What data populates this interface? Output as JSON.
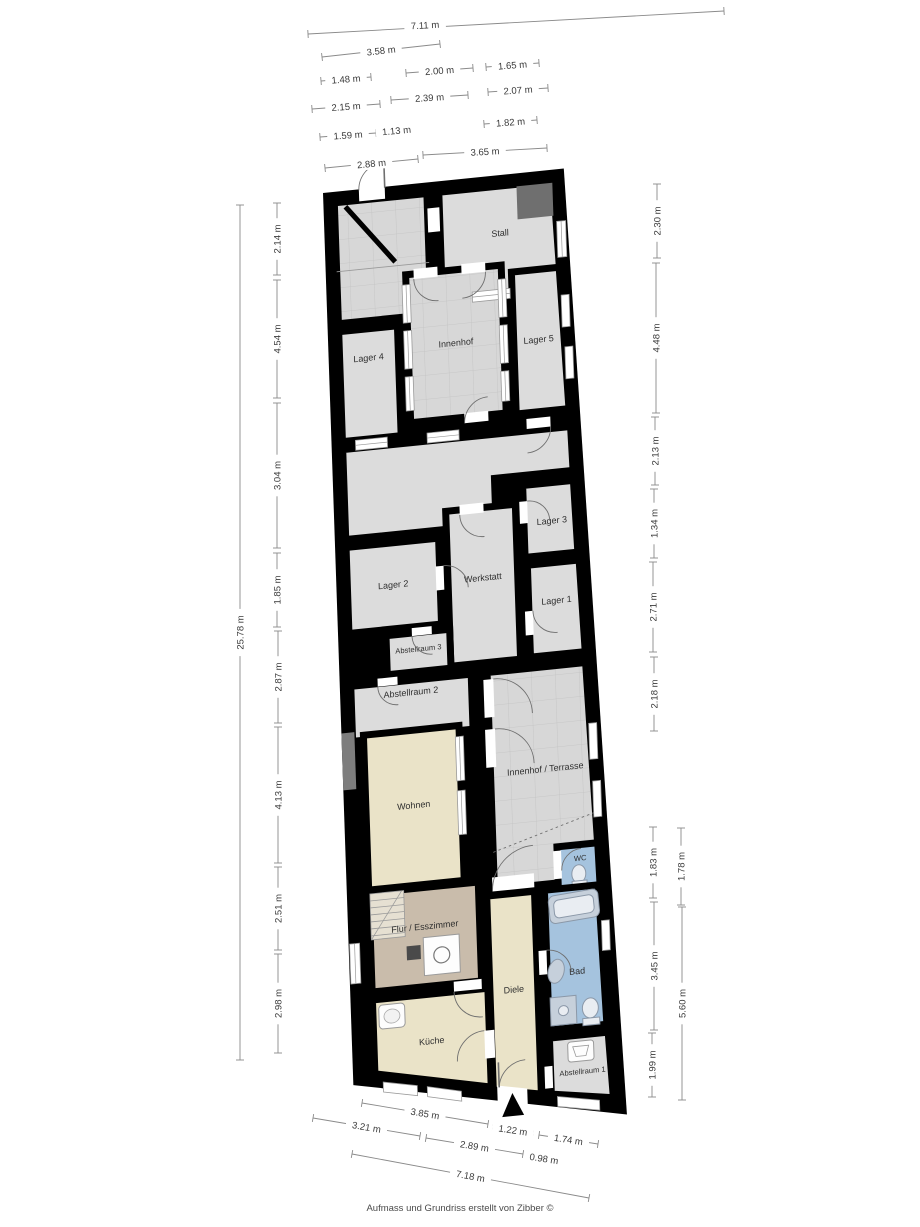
{
  "footer": {
    "credit": "Aufmass und Grundriss erstellt von Zibber ©"
  },
  "colors": {
    "wall": "#000000",
    "room_gray": "#dcdcdc",
    "courtyard_gray": "#d7d7d7",
    "living_cream": "#eae3c8",
    "hall_tan": "#c9bcab",
    "bath_blue": "#a5c3de",
    "dark_block_gray": "#6f6f6f",
    "wall_block_gray": "#7d7d7d",
    "dimension_text": "#3a3a3a"
  },
  "rooms": [
    {
      "id": "stall",
      "label": "Stall"
    },
    {
      "id": "lager-4",
      "label": "Lager 4"
    },
    {
      "id": "innenhof",
      "label": "Innenhof"
    },
    {
      "id": "lager-5",
      "label": "Lager 5"
    },
    {
      "id": "lager-3",
      "label": "Lager 3"
    },
    {
      "id": "lager-2",
      "label": "Lager 2"
    },
    {
      "id": "werkstatt",
      "label": "Werkstatt"
    },
    {
      "id": "lager-1",
      "label": "Lager 1"
    },
    {
      "id": "abstellraum-3",
      "label": "Abstellraum 3"
    },
    {
      "id": "abstellraum-2",
      "label": "Abstellraum 2"
    },
    {
      "id": "innenhof-terrasse",
      "label": "Innenhof / Terrasse"
    },
    {
      "id": "wohnen",
      "label": "Wohnen"
    },
    {
      "id": "wc",
      "label": "WC"
    },
    {
      "id": "flur-esszimmer",
      "label": "Flur / Esszimmer"
    },
    {
      "id": "diele",
      "label": "Diele"
    },
    {
      "id": "bad",
      "label": "Bad"
    },
    {
      "id": "kueche",
      "label": "Küche"
    },
    {
      "id": "abstellraum-1",
      "label": "Abstellraum 1"
    }
  ],
  "measurements": [
    {
      "group": "top",
      "label": "7.11 m",
      "x1": 308,
      "y1": 34,
      "x2": 724,
      "y2": 11,
      "lx": 425,
      "ly": 25
    },
    {
      "group": "top",
      "label": "3.58 m",
      "x1": 322,
      "y1": 57,
      "x2": 440,
      "y2": 44
    },
    {
      "group": "top",
      "label": "1.48 m",
      "x1": 321,
      "y1": 81,
      "x2": 371,
      "y2": 77
    },
    {
      "group": "top",
      "label": "2.00 m",
      "x1": 406,
      "y1": 73,
      "x2": 473,
      "y2": 68
    },
    {
      "group": "top",
      "label": "1.65 m",
      "x1": 486,
      "y1": 67,
      "x2": 539,
      "y2": 63
    },
    {
      "group": "top",
      "label": "2.15 m",
      "x1": 312,
      "y1": 109,
      "x2": 380,
      "y2": 104
    },
    {
      "group": "top",
      "label": "2.39 m",
      "x1": 391,
      "y1": 100,
      "x2": 468,
      "y2": 95
    },
    {
      "group": "top",
      "label": "2.07 m",
      "x1": 488,
      "y1": 92,
      "x2": 548,
      "y2": 88
    },
    {
      "group": "top",
      "label": "1.59 m",
      "x1": 320,
      "y1": 137,
      "x2": 376,
      "y2": 133
    },
    {
      "group": "top",
      "label": "1.13 m",
      "x1": 380,
      "y1": 132,
      "x2": 413,
      "y2": 129
    },
    {
      "group": "top",
      "label": "1.82 m",
      "x1": 484,
      "y1": 124,
      "x2": 537,
      "y2": 120
    },
    {
      "group": "top",
      "label": "2.88 m",
      "x1": 325,
      "y1": 168,
      "x2": 418,
      "y2": 159
    },
    {
      "group": "top",
      "label": "3.65 m",
      "x1": 423,
      "y1": 155,
      "x2": 547,
      "y2": 148
    },
    {
      "group": "left",
      "label": "25.78 m",
      "x1": 240,
      "y1": 1060,
      "x2": 240,
      "y2": 205
    },
    {
      "group": "left",
      "label": "2.14 m",
      "x1": 277,
      "y1": 275,
      "x2": 277,
      "y2": 203
    },
    {
      "group": "left",
      "label": "4.54 m",
      "x1": 277,
      "y1": 398,
      "x2": 277,
      "y2": 280
    },
    {
      "group": "left",
      "label": "3.04 m",
      "x1": 277,
      "y1": 548,
      "x2": 277,
      "y2": 403
    },
    {
      "group": "left",
      "label": "1.85 m",
      "x1": 277,
      "y1": 627,
      "x2": 277,
      "y2": 553
    },
    {
      "group": "left",
      "label": "2.87 m",
      "x1": 278,
      "y1": 723,
      "x2": 278,
      "y2": 631
    },
    {
      "group": "left",
      "label": "4.13 m",
      "x1": 278,
      "y1": 863,
      "x2": 278,
      "y2": 727
    },
    {
      "group": "left",
      "label": "2.51 m",
      "x1": 278,
      "y1": 950,
      "x2": 278,
      "y2": 867
    },
    {
      "group": "left",
      "label": "2.98 m",
      "x1": 278,
      "y1": 1053,
      "x2": 278,
      "y2": 954
    },
    {
      "group": "right",
      "label": "2.30 m",
      "x1": 657,
      "y1": 258,
      "x2": 657,
      "y2": 184
    },
    {
      "group": "right",
      "label": "4.48 m",
      "x1": 656,
      "y1": 413,
      "x2": 656,
      "y2": 263
    },
    {
      "group": "right",
      "label": "2.13 m",
      "x1": 655,
      "y1": 485,
      "x2": 655,
      "y2": 417
    },
    {
      "group": "right",
      "label": "1.34 m",
      "x1": 654,
      "y1": 558,
      "x2": 654,
      "y2": 489
    },
    {
      "group": "right",
      "label": "2.71 m",
      "x1": 653,
      "y1": 652,
      "x2": 653,
      "y2": 562
    },
    {
      "group": "right",
      "label": "2.18 m",
      "x1": 654,
      "y1": 731,
      "x2": 654,
      "y2": 657
    },
    {
      "group": "right",
      "label": "1.83 m",
      "x1": 653,
      "y1": 898,
      "x2": 653,
      "y2": 827
    },
    {
      "group": "right",
      "label": "3.45 m",
      "x1": 654,
      "y1": 1030,
      "x2": 654,
      "y2": 902
    },
    {
      "group": "right",
      "label": "1.99 m",
      "x1": 652,
      "y1": 1097,
      "x2": 652,
      "y2": 1033
    },
    {
      "group": "right-outer",
      "label": "1.78 m",
      "x1": 681,
      "y1": 905,
      "x2": 681,
      "y2": 828
    },
    {
      "group": "right-outer",
      "label": "5.60 m",
      "x1": 682,
      "y1": 1100,
      "x2": 682,
      "y2": 907
    },
    {
      "group": "bottom",
      "label": "3.85 m",
      "x1": 362,
      "y1": 1103,
      "x2": 488,
      "y2": 1124
    },
    {
      "group": "bottom",
      "label": "1.22 m",
      "x1": 493,
      "y1": 1127,
      "x2": 533,
      "y2": 1133
    },
    {
      "group": "bottom",
      "label": "1.74 m",
      "x1": 539,
      "y1": 1135,
      "x2": 598,
      "y2": 1144
    },
    {
      "group": "bottom",
      "label": "3.21 m",
      "x1": 313,
      "y1": 1118,
      "x2": 420,
      "y2": 1136
    },
    {
      "group": "bottom",
      "label": "2.89 m",
      "x1": 426,
      "y1": 1138,
      "x2": 523,
      "y2": 1154
    },
    {
      "group": "bottom",
      "label": "0.98 m",
      "x1": 528,
      "y1": 1156,
      "x2": 560,
      "y2": 1161
    },
    {
      "group": "bottom",
      "label": "7.18 m",
      "x1": 352,
      "y1": 1154,
      "x2": 589,
      "y2": 1198
    }
  ]
}
